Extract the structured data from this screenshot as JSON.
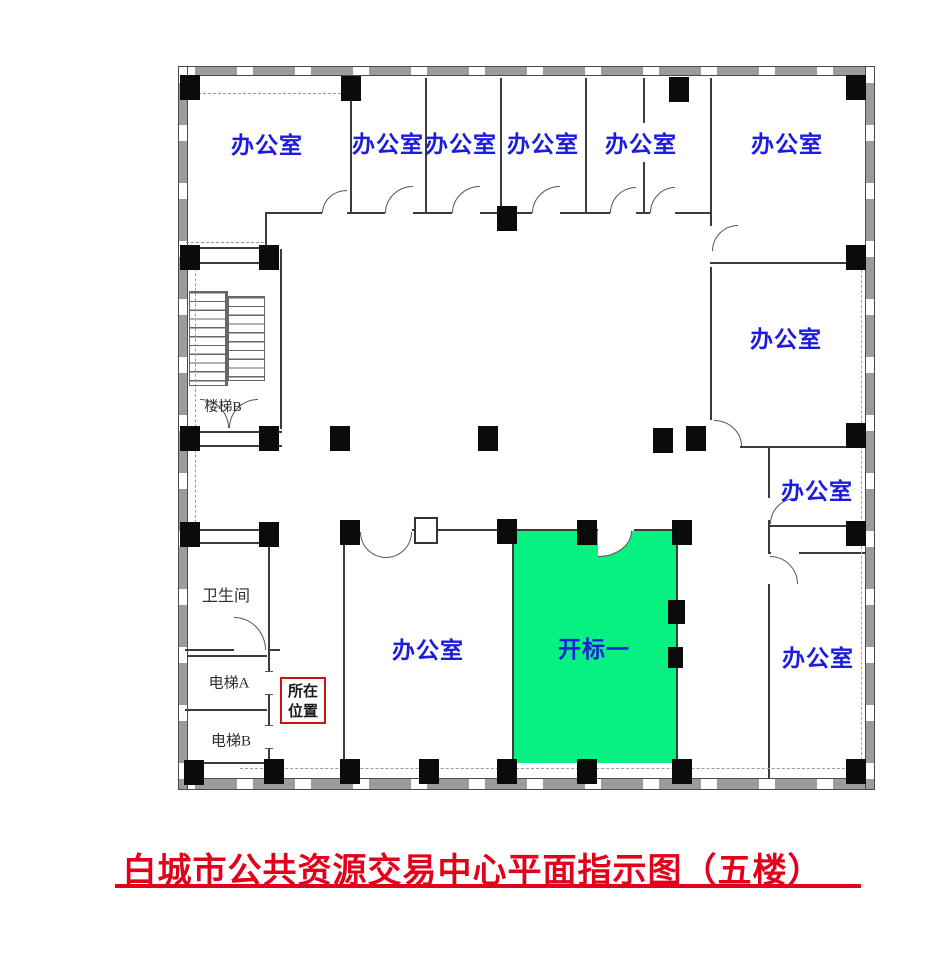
{
  "title": {
    "text": "白城市公共资源交易中心平面指示图（五楼）"
  },
  "colors": {
    "label_blue": "#1c1cdf",
    "room_green": "#06f182",
    "title_red": "#e3001b",
    "wall": "#3c3c3c",
    "column": "#0b0b0b",
    "location_red": "#c51414",
    "small_label": "#2f2f2f"
  },
  "rooms": {
    "top_left_office": {
      "label": "办公室"
    },
    "top_office_1": {
      "label": "办公室"
    },
    "top_office_2": {
      "label": "办公室"
    },
    "top_office_3": {
      "label": "办公室"
    },
    "top_office_4": {
      "label": "办公室"
    },
    "top_right_office": {
      "label": "办公室"
    },
    "right_middle_office": {
      "label": "办公室"
    },
    "right_small_office": {
      "label": "办公室"
    },
    "right_bottom_office": {
      "label": "办公室"
    },
    "bottom_center_office": {
      "label": "办公室"
    },
    "bid_opening_room": {
      "label": "开标一"
    },
    "stairs_b": {
      "label": "楼梯B"
    },
    "restroom": {
      "label": "卫生间"
    },
    "elevator_a": {
      "label": "电梯A"
    },
    "elevator_b": {
      "label": "电梯B"
    }
  },
  "location_marker": {
    "line1": "所在",
    "line2": "位置"
  }
}
